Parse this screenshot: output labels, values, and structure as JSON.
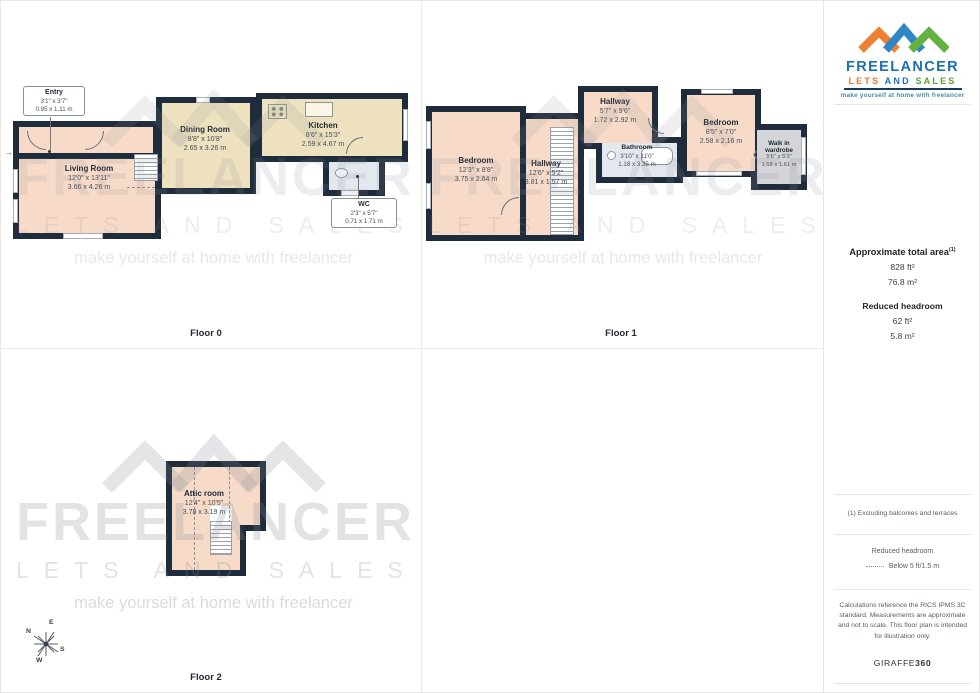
{
  "branding": {
    "name": "FREELANCER",
    "lets": "LETS",
    "and": "AND",
    "sales": "SALES",
    "tagline": "make yourself at home with freelancer",
    "watermark_name": "FREELANCER",
    "watermark_sub": "LETS AND SALES",
    "watermark_tagline": "make yourself at home with freelancer",
    "colors": {
      "orange": "#e87a2e",
      "blue": "#1a6fb5",
      "green": "#5aa332",
      "wall": "#1f2c3c"
    }
  },
  "floors": {
    "floor0": {
      "label": "Floor 0",
      "rooms": {
        "entry": {
          "name": "Entry",
          "imperial": "3'1\" x 3'7\"",
          "metric": "0.95 x 1.11 m"
        },
        "living": {
          "name": "Living Room",
          "imperial": "12'0\" x 13'11\"",
          "metric": "3.66 x 4.26 m"
        },
        "dining": {
          "name": "Dining Room",
          "imperial": "8'8\" x 10'8\"",
          "metric": "2.65 x 3.26 m"
        },
        "kitchen": {
          "name": "Kitchen",
          "imperial": "8'6\" x 15'3\"",
          "metric": "2.59 x 4.67 m"
        },
        "wc": {
          "name": "WC",
          "imperial": "2'3\" x 5'7\"",
          "metric": "0.71 x 1.71 m"
        }
      }
    },
    "floor1": {
      "label": "Floor 1",
      "rooms": {
        "bedroom_left": {
          "name": "Bedroom",
          "imperial": "12'3\" x 8'8\"",
          "metric": "3.75 x 2.64 m"
        },
        "hallway_main": {
          "name": "Hallway",
          "imperial": "12'6\" x 5'2\"",
          "metric": "3.81 x 1.57 m"
        },
        "hallway_top": {
          "name": "Hallway",
          "imperial": "5'7\" x 9'6\"",
          "metric": "1.72 x 2.92 m"
        },
        "bathroom": {
          "name": "Bathroom",
          "imperial": "3'10\" x 11'0\"",
          "metric": "1.18 x 3.35 m"
        },
        "bedroom_right": {
          "name": "Bedroom",
          "imperial": "8'5\" x 7'0\"",
          "metric": "2.58 x 2.16 m"
        },
        "wardrobe": {
          "name_line1": "Walk in",
          "name_line2": "wardrobe",
          "imperial": "5'6\" x 5'3\"",
          "metric": "1.68 x 1.61 m"
        }
      }
    },
    "floor2": {
      "label": "Floor 2",
      "rooms": {
        "attic": {
          "name": "Attic room",
          "imperial": "12'4\" x 10'5\"",
          "metric": "3.78 x 3.19 m"
        }
      }
    }
  },
  "compass": {
    "n": "N",
    "e": "E",
    "s": "S",
    "w": "W"
  },
  "sidebar": {
    "area_title": "Approximate total area",
    "area_sup": "(1)",
    "area_ft": "828 ft²",
    "area_m": "76.8 m²",
    "headroom_title": "Reduced headroom",
    "headroom_ft": "62 ft²",
    "headroom_m": "5.8 m²",
    "note1": "(1) Excluding balconies and terraces",
    "legend_title": "Reduced headroom",
    "legend_value": "Below 5 ft/1.5 m",
    "disclaimer": "Calculations reference the RICS IPMS 3C standard. Measurements are approximate and not to scale. This floor plan is intended for illustration only.",
    "footer_brand": "GIRAFFE",
    "footer_brand_bold": "360"
  }
}
